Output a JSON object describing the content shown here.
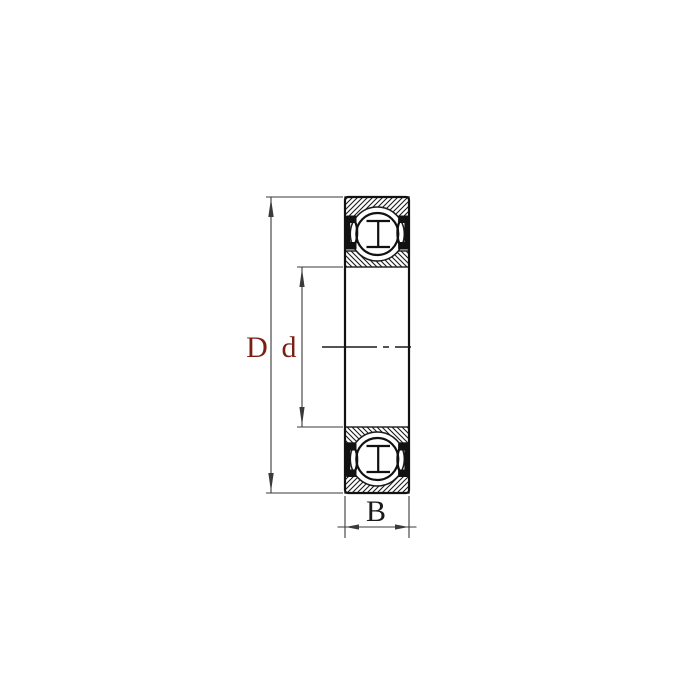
{
  "drawing": {
    "type": "deep-groove-ball-bearing-2RS-cross-section",
    "labels": {
      "outer_diameter": "D",
      "bore_diameter": "d",
      "width": "B"
    },
    "colors": {
      "line": "#1a1a1a",
      "diameter_label": "#7b1e14",
      "width_label": "#1a1a1a",
      "background": "#ffffff"
    }
  }
}
